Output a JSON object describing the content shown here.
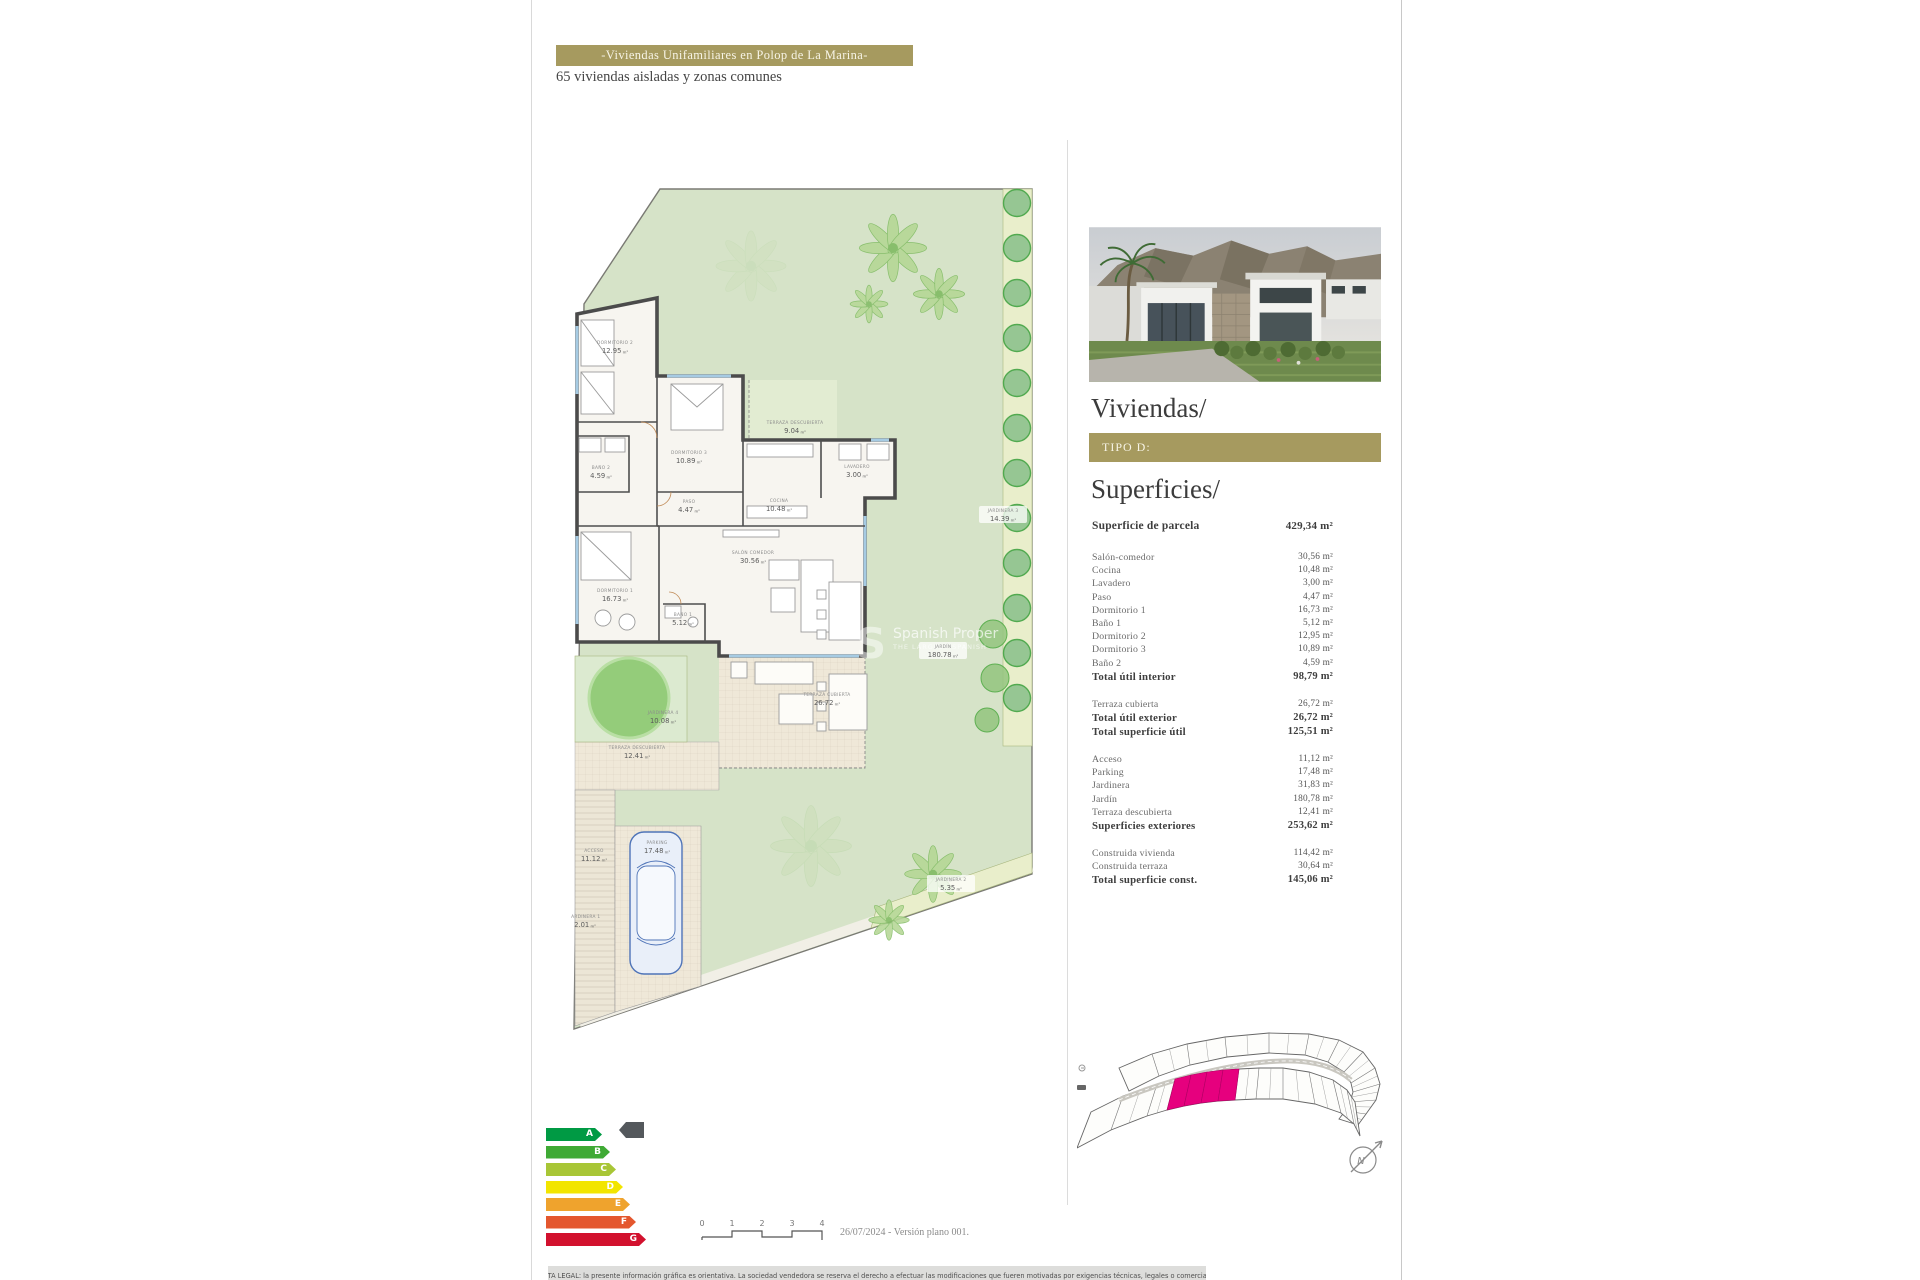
{
  "header": {
    "title": "-Viviendas Unifamiliares en Polop de La Marina-",
    "subtitle": "65 viviendas aisladas y zonas comunes"
  },
  "sidebar": {
    "viviendas_title": "Viviendas/",
    "tipo_label": "TIPO D:",
    "superficies_title": "Superficies/",
    "surfaces": {
      "groups": [
        {
          "rows": [
            {
              "label": "Superficie de parcela",
              "value": "429,34 m²",
              "bold": true,
              "lead": true
            }
          ]
        },
        {
          "rows": [
            {
              "label": "Salón-comedor",
              "value": "30,56 m²"
            },
            {
              "label": "Cocina",
              "value": "10,48 m²"
            },
            {
              "label": "Lavadero",
              "value": "3,00 m²"
            },
            {
              "label": "Paso",
              "value": "4,47 m²"
            },
            {
              "label": "Dormitorio 1",
              "value": "16,73 m²"
            },
            {
              "label": "Baño 1",
              "value": "5,12 m²"
            },
            {
              "label": "Dormitorio 2",
              "value": "12,95 m²"
            },
            {
              "label": "Dormitorio 3",
              "value": "10,89 m²"
            },
            {
              "label": "Baño 2",
              "value": "4,59 m²"
            },
            {
              "label": "Total útil interior",
              "value": "98,79 m²",
              "bold": true
            }
          ]
        },
        {
          "rows": [
            {
              "label": "Terraza cubierta",
              "value": "26,72 m²"
            },
            {
              "label": "Total útil exterior",
              "value": "26,72 m²",
              "bold": true
            },
            {
              "label": "Total superficie útil",
              "value": "125,51 m²",
              "bold": true
            }
          ]
        },
        {
          "rows": [
            {
              "label": "Acceso",
              "value": "11,12 m²"
            },
            {
              "label": "Parking",
              "value": "17,48 m²"
            },
            {
              "label": "Jardinera",
              "value": "31,83 m²"
            },
            {
              "label": "Jardín",
              "value": "180,78 m²"
            },
            {
              "label": "Terraza descubierta",
              "value": "12,41 m²"
            },
            {
              "label": "Superficies exteriores",
              "value": "253,62 m²",
              "bold": true
            }
          ]
        },
        {
          "rows": [
            {
              "label": "Construida vivienda",
              "value": "114,42 m²"
            },
            {
              "label": "Construida terraza",
              "value": "30,64 m²"
            },
            {
              "label": "Total superficie const.",
              "value": "145,06 m²",
              "bold": true
            }
          ]
        }
      ]
    }
  },
  "floor_plan": {
    "rooms": [
      {
        "name": "DORMITORIO 2",
        "area": "12.95",
        "unit": "m²",
        "x": 44,
        "y": 158
      },
      {
        "name": "DORMITORIO 3",
        "area": "10.89",
        "unit": "m²",
        "x": 118,
        "y": 268
      },
      {
        "name": "BAÑO 2",
        "area": "4.59",
        "unit": "m²",
        "x": 30,
        "y": 283
      },
      {
        "name": "PASO",
        "area": "4.47",
        "unit": "m²",
        "x": 118,
        "y": 317
      },
      {
        "name": "COCINA",
        "area": "10.48",
        "unit": "m²",
        "x": 208,
        "y": 316
      },
      {
        "name": "LAVADERO",
        "area": "3.00",
        "unit": "m²",
        "x": 286,
        "y": 282
      },
      {
        "name": "TERRAZA DESCUBIERTA",
        "area": "9.04",
        "unit": "m²",
        "x": 224,
        "y": 238
      },
      {
        "name": "DORMITORIO 1",
        "area": "16.73",
        "unit": "m²",
        "x": 44,
        "y": 406
      },
      {
        "name": "BAÑO 1",
        "area": "5.12",
        "unit": "m²",
        "x": 112,
        "y": 430
      },
      {
        "name": "SALÓN COMEDOR",
        "area": "30.56",
        "unit": "m²",
        "x": 182,
        "y": 368
      },
      {
        "name": "JARDINERA 4",
        "area": "10.08",
        "unit": "m²",
        "x": 92,
        "y": 528
      },
      {
        "name": "TERRAZA DESCUBIERTA",
        "area": "12.41",
        "unit": "m²",
        "x": 66,
        "y": 563
      },
      {
        "name": "TERRAZA CUBIERTA",
        "area": "26.72",
        "unit": "m²",
        "x": 256,
        "y": 510
      },
      {
        "name": "JARDÍN",
        "area": "180.78",
        "unit": "m²",
        "x": 372,
        "y": 462,
        "chip": true
      },
      {
        "name": "ACCESO",
        "area": "11.12",
        "unit": "m²",
        "x": 23,
        "y": 666
      },
      {
        "name": "PARKING",
        "area": "17.48",
        "unit": "m²",
        "x": 86,
        "y": 658
      },
      {
        "name": "JARDINERA 1",
        "area": "2.01",
        "unit": "m²",
        "x": 14,
        "y": 732
      },
      {
        "name": "JARDINERA 2",
        "area": "5.35",
        "unit": "m²",
        "x": 380,
        "y": 695,
        "chip": true
      },
      {
        "name": "JARDINERA 3",
        "area": "14.39",
        "unit": "m²",
        "x": 432,
        "y": 326,
        "chip": true
      }
    ],
    "watermark": {
      "initial": "S",
      "line1": "Spanish Proper",
      "line2": "THE LARGEST SPANISH"
    }
  },
  "site_plan": {
    "compass_label": "N",
    "highlight_color": "#e6007e"
  },
  "energy_rating": {
    "marker_color": "#54585c",
    "bands": [
      {
        "label": "A",
        "color": "#009a44",
        "width": 56
      },
      {
        "label": "B",
        "color": "#3faa35",
        "width": 64
      },
      {
        "label": "C",
        "color": "#a8c636",
        "width": 70
      },
      {
        "label": "D",
        "color": "#f2e500",
        "width": 77
      },
      {
        "label": "E",
        "color": "#efa32d",
        "width": 84
      },
      {
        "label": "F",
        "color": "#e4572e",
        "width": 90
      },
      {
        "label": "G",
        "color": "#d2112e",
        "width": 100
      }
    ]
  },
  "footer": {
    "scale_ticks": [
      "0",
      "1",
      "2",
      "3",
      "4"
    ],
    "date_version": "26/07/2024 - Versión plano 001.",
    "legal": "NOTA LEGAL: la presente información gráfica es orientativa. La sociedad vendedora se reserva el derecho a efectuar las modificaciones que fueren motivadas por exigencias técnicas, legales o comerciales"
  }
}
